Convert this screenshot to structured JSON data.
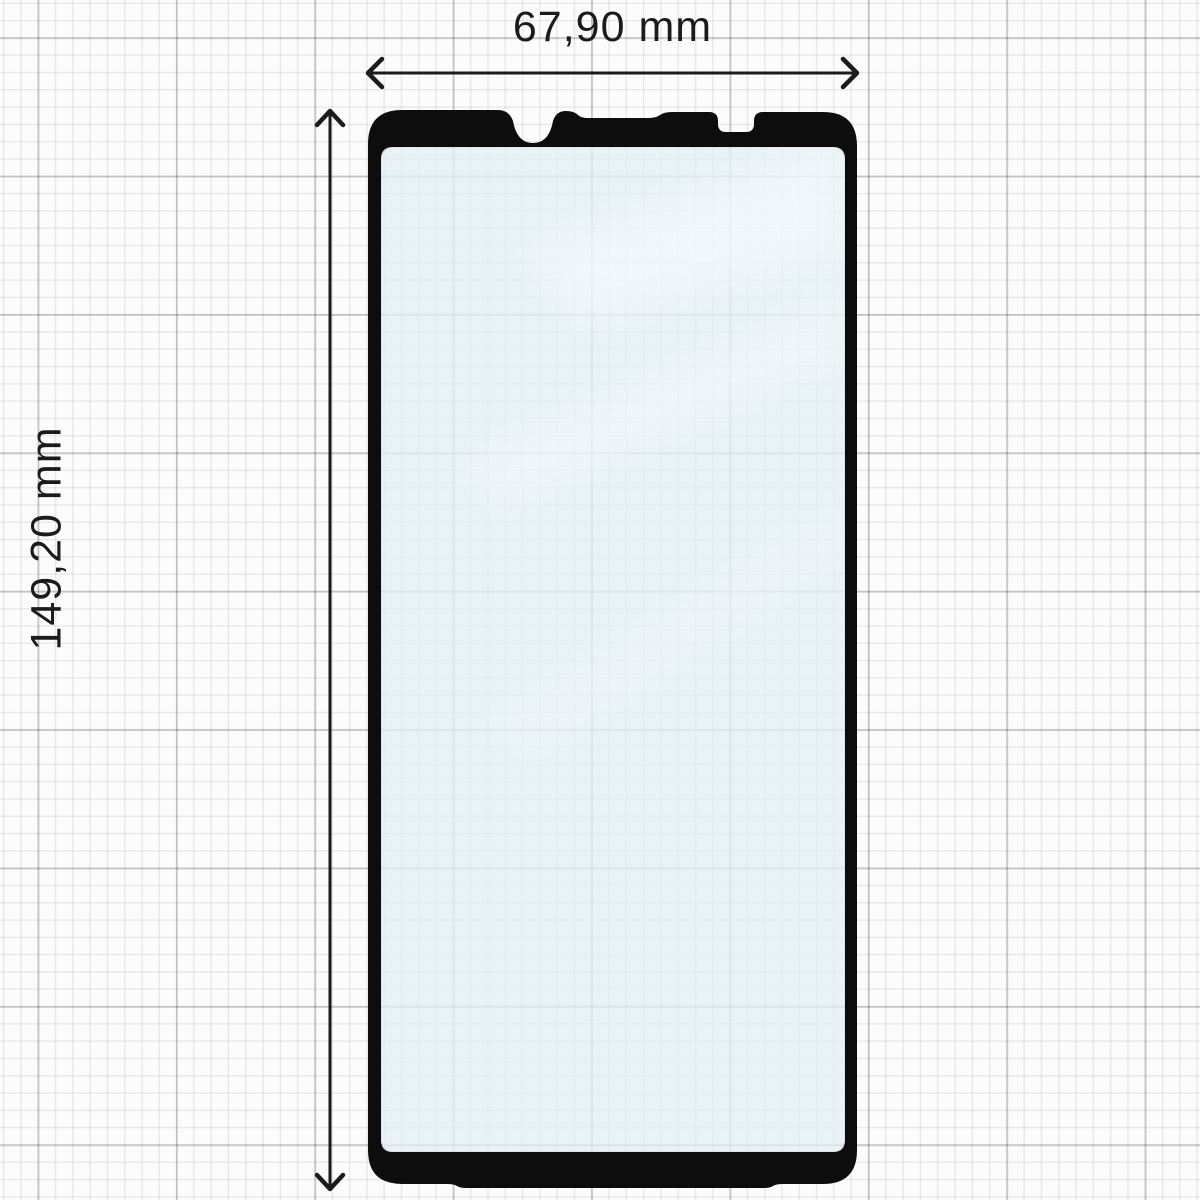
{
  "diagram": {
    "horizontal_dimension": {
      "label": "67,90 mm"
    },
    "vertical_dimension": {
      "label": "149,20 mm"
    }
  },
  "colors": {
    "frame": "#0d0d0d",
    "glass": "#e2eef5",
    "reflection": "#ffffff",
    "arrow": "#1b1b1b",
    "text": "#1b1b1b",
    "background": "#fcfcfc",
    "grid_minor": "#ececec",
    "grid_major": "#d7d7d7"
  }
}
